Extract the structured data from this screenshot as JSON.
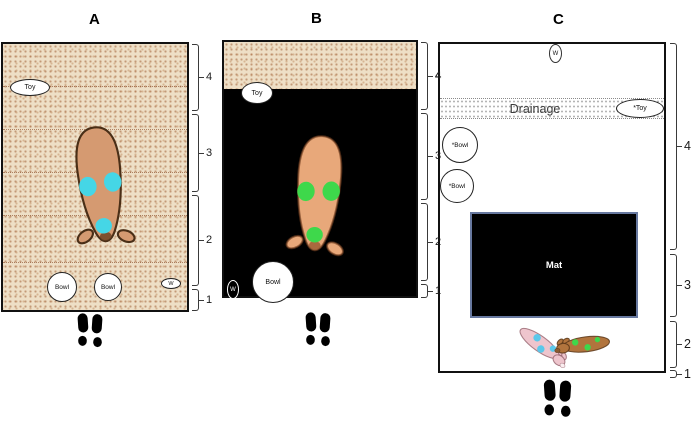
{
  "figure": {
    "panels": [
      {
        "letter": "A",
        "zone_labels": [
          "4",
          "3",
          "2",
          "1"
        ],
        "items": {
          "toy": "Toy",
          "bowl_left": "Bowl",
          "bowl_right": "Bowl",
          "water": "W"
        }
      },
      {
        "letter": "B",
        "zone_labels": [
          "4",
          "3",
          "2",
          "1"
        ],
        "items": {
          "toy": "Toy",
          "bowl": "Bowl",
          "water": "W"
        }
      },
      {
        "letter": "C",
        "zone_labels": [
          "4",
          "3",
          "2",
          "1"
        ],
        "items": {
          "water": "W",
          "drainage": "Drainage",
          "toy": "*Toy",
          "bowl_upper": "*Bowl",
          "bowl_lower": "*Bowl",
          "mat": "Mat"
        }
      }
    ],
    "colors": {
      "sand": "#eedfc6",
      "sand_speck": "#a05f37",
      "pen_border": "#111111",
      "floor_black": "#000000",
      "mat_border": "#67789f",
      "pig_tan": "#d59a71",
      "pig_salmon": "#e8a87a",
      "pig_pink": "#eec5cd",
      "pig_brown": "#b1743d",
      "patch_cyan": "#45d6e6",
      "patch_green": "#3ed84b",
      "patch_blue": "#5bc8ea"
    }
  }
}
